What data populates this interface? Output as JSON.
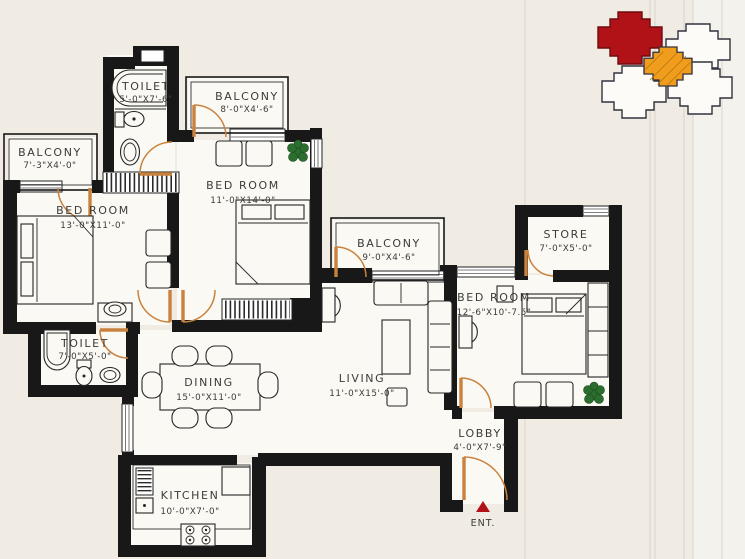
{
  "theme": {
    "paper": "#f0ece4",
    "ink": "#181818",
    "floor": "#fbf9f4",
    "door": "#c9823e",
    "plant": "#2c6e2f",
    "accent_red": "#b01217",
    "accent_orange": "#f09d1e",
    "site_outline": "#32323e",
    "fold": "#d9d5cb",
    "band": "#f4f2ec",
    "label": "#3b3b38"
  },
  "plan": {
    "rooms": [
      {
        "id": "toilet-top",
        "name": "TOILET",
        "dims": "5'-0\"X7'-6\""
      },
      {
        "id": "balcony-top",
        "name": "BALCONY",
        "dims": "8'-0\"X4'-6\""
      },
      {
        "id": "balcony-left",
        "name": "BALCONY",
        "dims": "7'-3\"X4'-0\""
      },
      {
        "id": "bedroom-left",
        "name": "BED ROOM",
        "dims": "13'-0\"X11'-0\""
      },
      {
        "id": "bedroom-mid",
        "name": "BED ROOM",
        "dims": "11'-0\"X14'-0\""
      },
      {
        "id": "balcony-mid",
        "name": "BALCONY",
        "dims": "9'-0\"X4'-6\""
      },
      {
        "id": "store",
        "name": "STORE",
        "dims": "7'-0\"X5'-0\""
      },
      {
        "id": "bedroom-right",
        "name": "BED ROOM",
        "dims": "12'-6\"X10'-7.5\""
      },
      {
        "id": "toilet-left",
        "name": "TOILET",
        "dims": "7'-0\"X5'-0\""
      },
      {
        "id": "dining",
        "name": "DINING",
        "dims": "15'-0\"X11'-0\""
      },
      {
        "id": "living",
        "name": "LIVING",
        "dims": "11'-0\"X15'-0\""
      },
      {
        "id": "lobby",
        "name": "LOBBY",
        "dims": "4'-0\"X7'-9\""
      },
      {
        "id": "kitchen",
        "name": "KITCHEN",
        "dims": "10'-0\"X7'-0\""
      }
    ],
    "entrance_label": "ENT."
  },
  "site_key": {
    "highlighted_unit_color": "#b01217",
    "selected_unit_color": "#f09d1e",
    "unit_outline_color": "#32323e"
  }
}
